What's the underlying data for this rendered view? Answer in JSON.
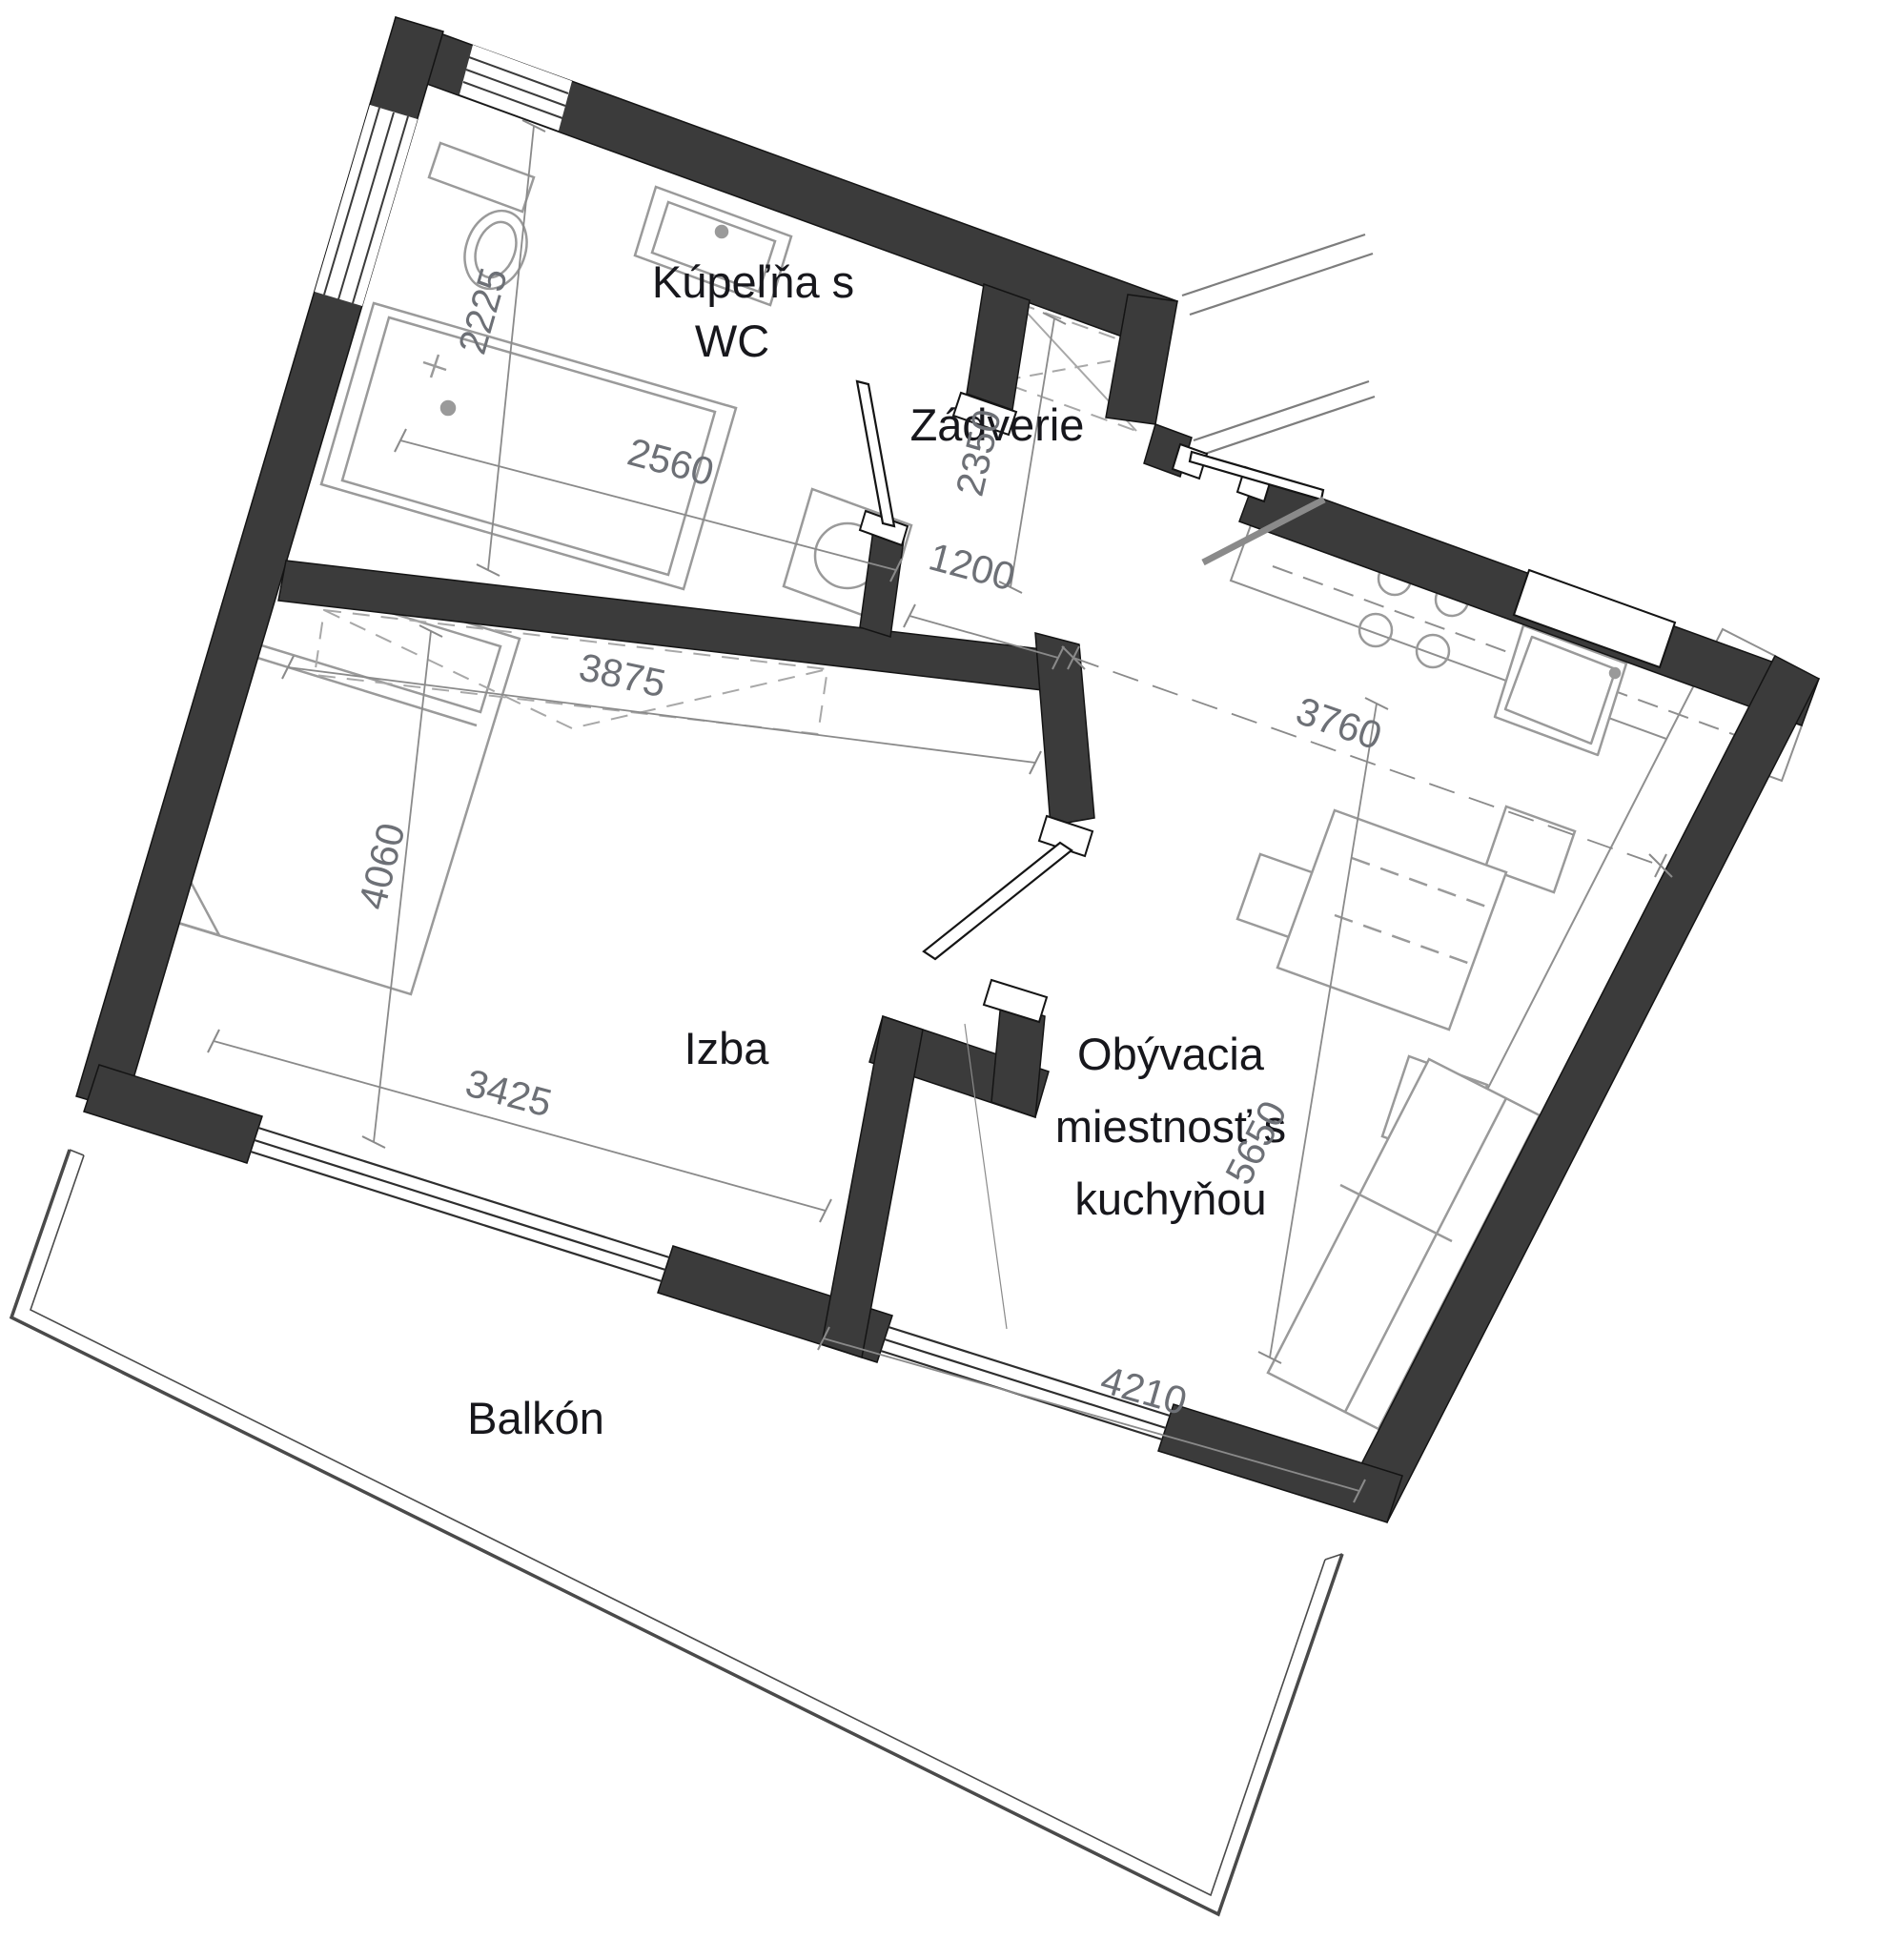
{
  "plan_title": "",
  "colors": {
    "wall": "#3b3b3b",
    "wall_edge": "#141414",
    "fixture_line": "#9a9a9a",
    "counter_line": "#8f8f8f",
    "dimension_text": "#6d7076",
    "room_label_text": "#17171c",
    "background": "#ffffff"
  },
  "rooms": [
    {
      "key": "bathroom",
      "label_lines": [
        "Kúpeľňa s",
        "WC"
      ],
      "dims_mm": [
        "2225",
        "2560"
      ]
    },
    {
      "key": "entrance_hall",
      "label_lines": [
        "Zádverie"
      ],
      "dims_mm": [
        "2350",
        "1200"
      ]
    },
    {
      "key": "bedroom",
      "label_lines": [
        "Izba"
      ],
      "dims_mm": [
        "3875",
        "4060",
        "3425"
      ]
    },
    {
      "key": "living_kitchen",
      "label_lines": [
        "Obývacia",
        "miestnosť s",
        "kuchyňou"
      ],
      "dims_mm": [
        "3760",
        "5650",
        "4210"
      ]
    },
    {
      "key": "balcony",
      "label_lines": [
        "Balkón"
      ],
      "dims_mm": []
    }
  ]
}
